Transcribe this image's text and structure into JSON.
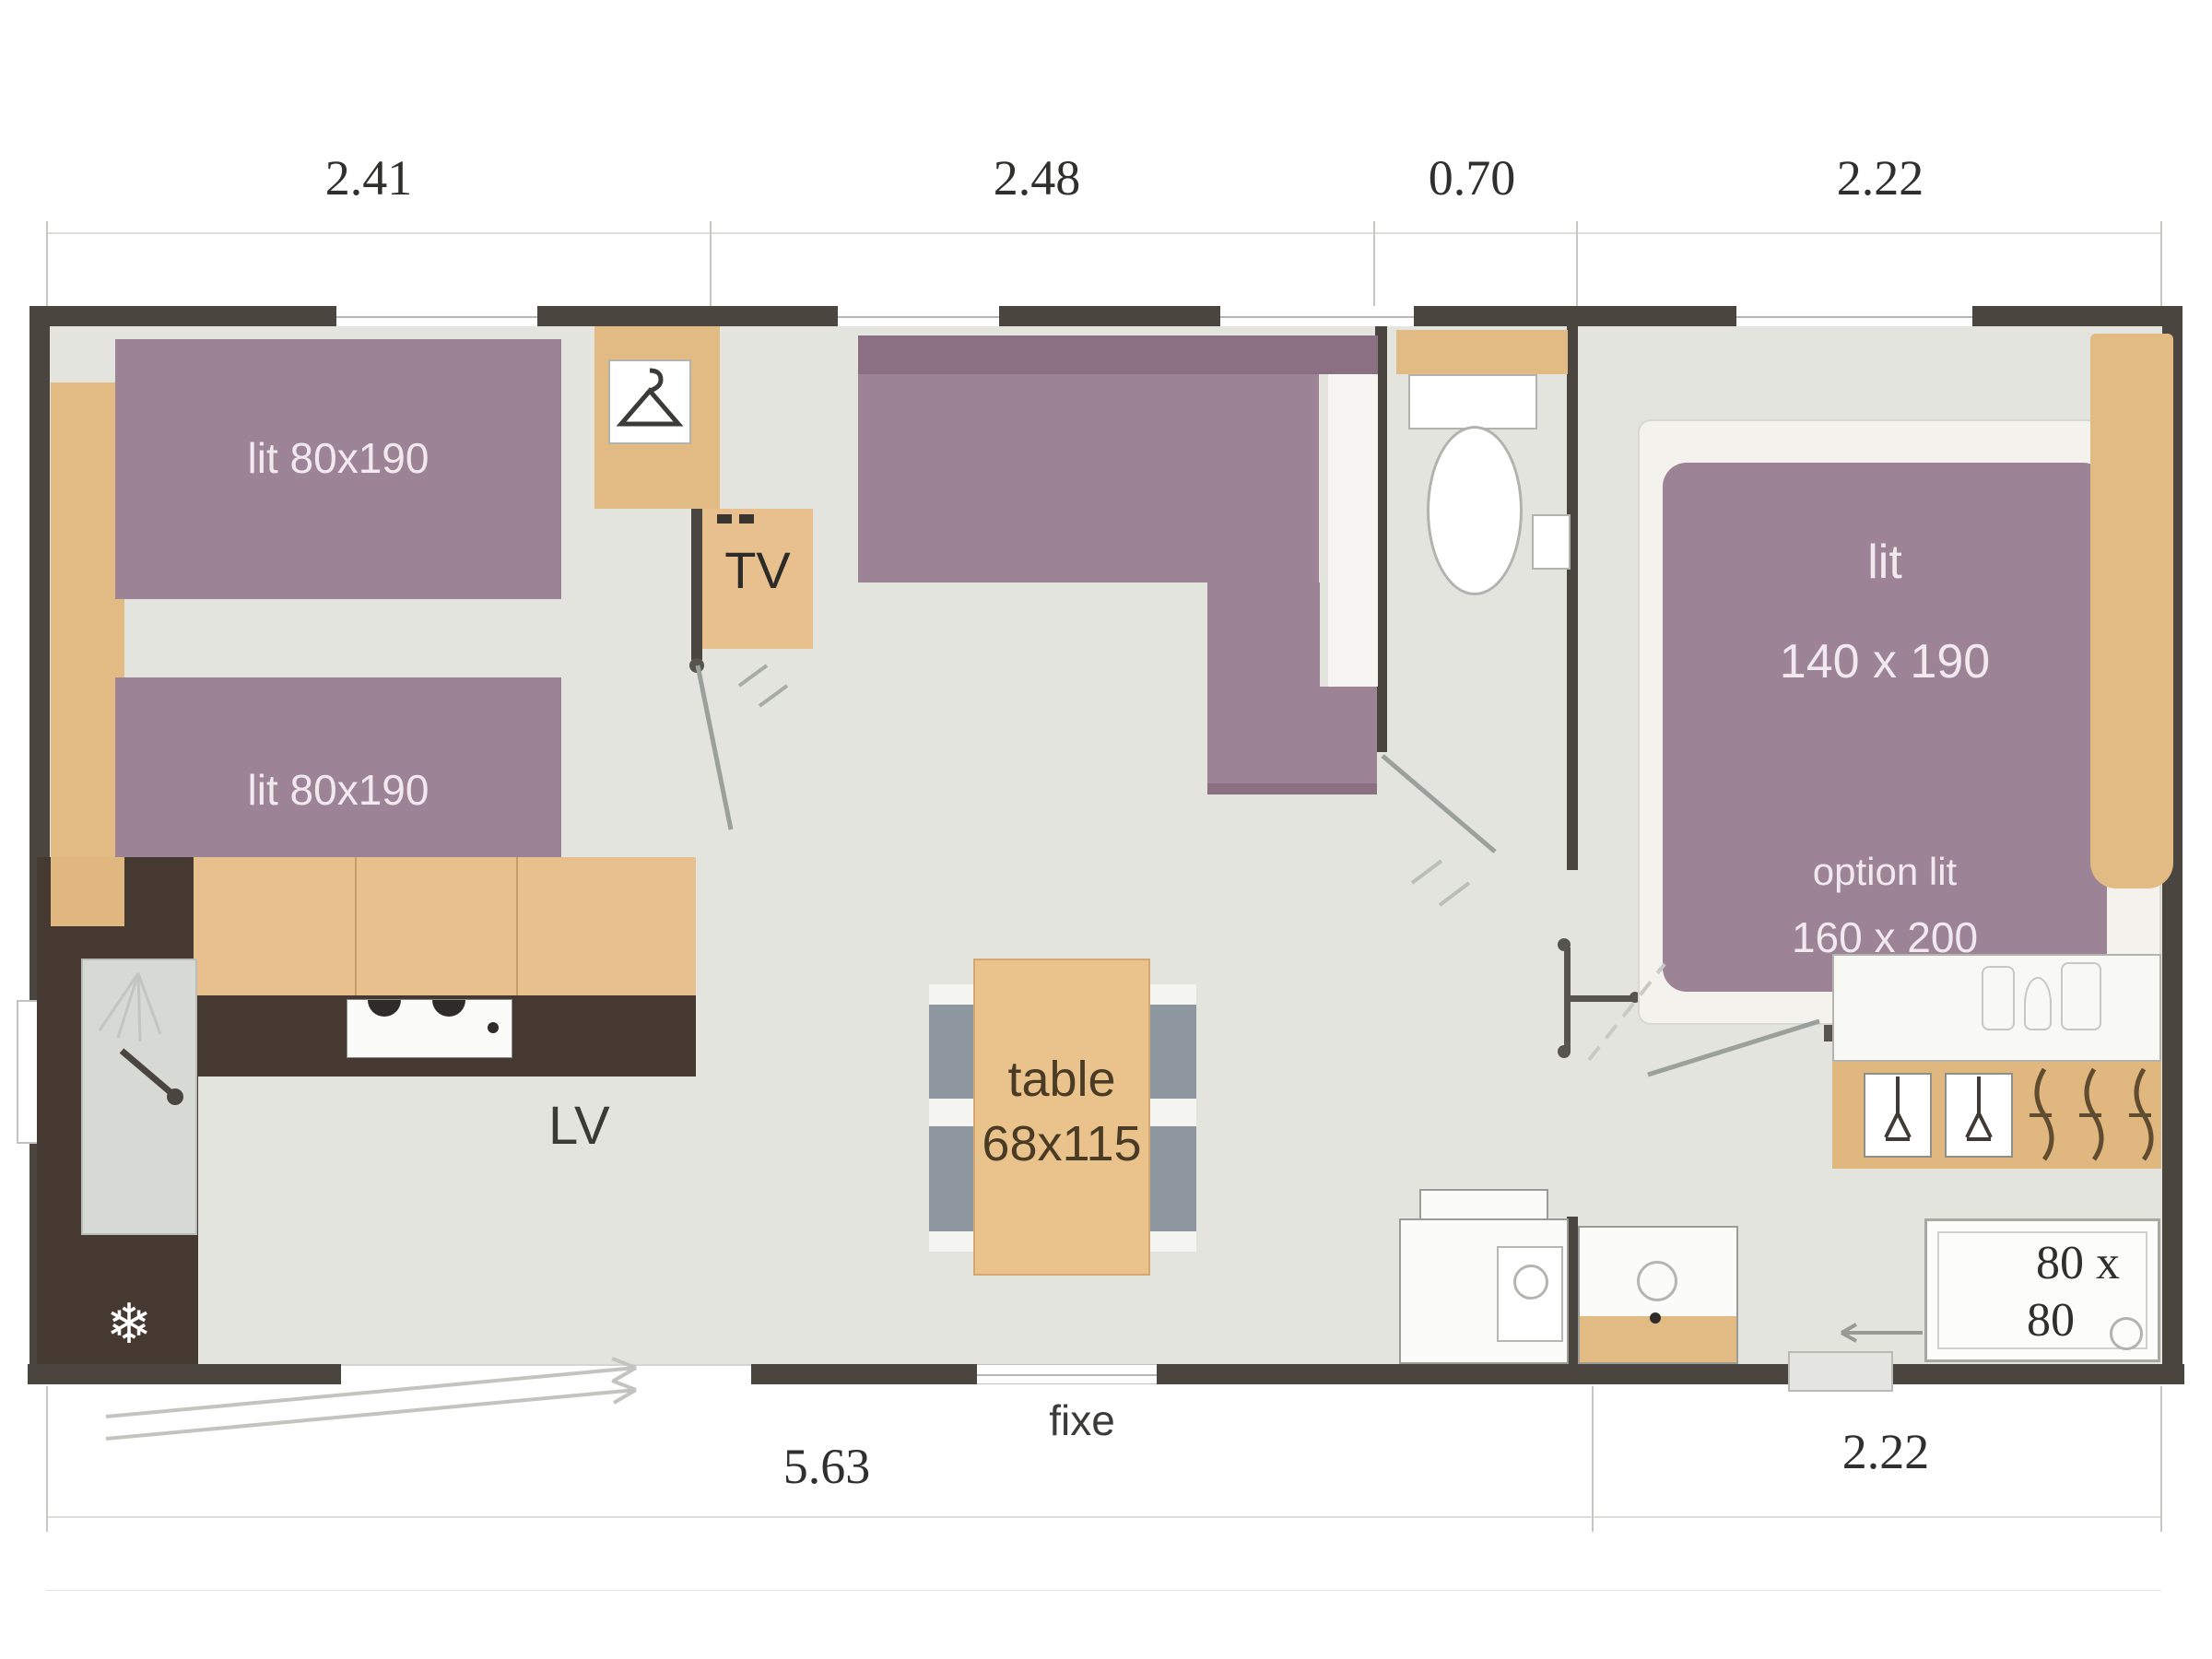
{
  "dims": {
    "top": [
      "2.41",
      "2.48",
      "0.70",
      "2.22"
    ],
    "bottom_left": "5.63",
    "bottom_right": "2.22",
    "window_label": "fixe"
  },
  "bedroom_left": {
    "bed_top_label": "lit 80x190",
    "bed_bottom_label": "lit 80x190",
    "tv_label": "TV"
  },
  "kitchen": {
    "dishwasher_label": "LV",
    "fridge_icon": "❄"
  },
  "dining": {
    "table_label": "table",
    "table_size": "68x115"
  },
  "bedroom_right": {
    "bed_label": "lit",
    "bed_size": "140 x 190",
    "option_label": "option lit",
    "option_size": "160 x 200"
  },
  "bathroom": {
    "shower_size_line1": "80 x",
    "shower_size_line2": "80"
  },
  "colors": {
    "wall": "#4b4540",
    "floor": "#e4e4df",
    "furniture_purple": "#9c8395",
    "wood": "#e2ba84",
    "counter_dark": "#463931"
  }
}
